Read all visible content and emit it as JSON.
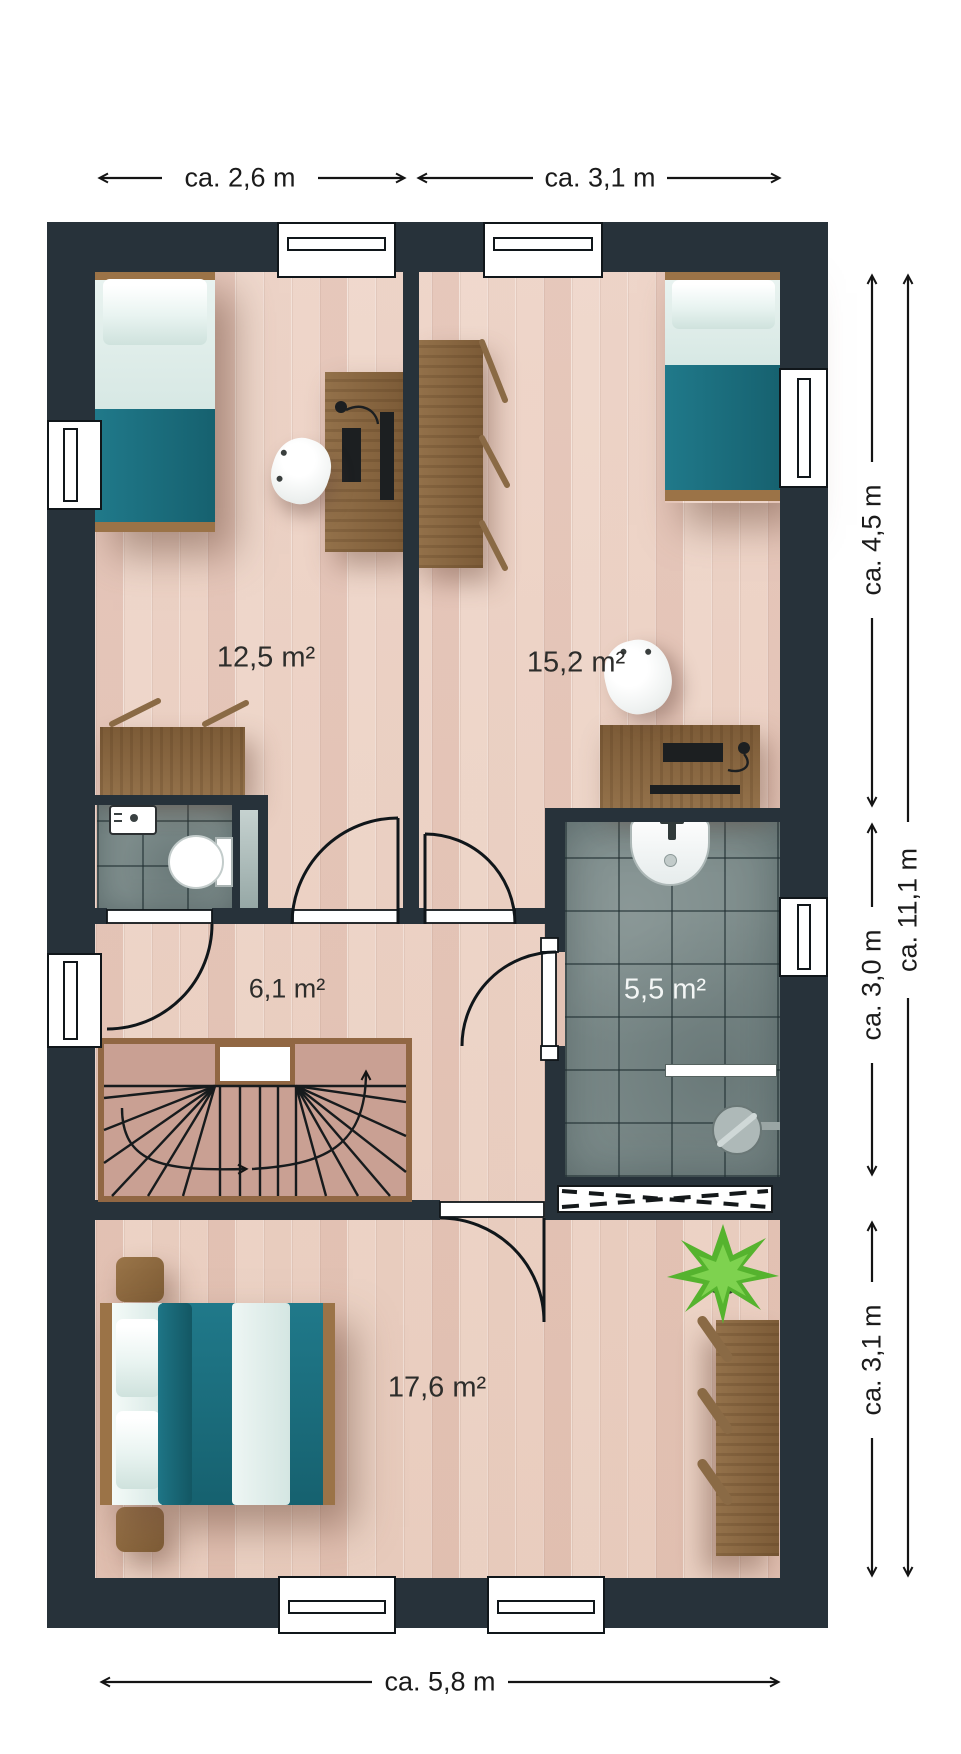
{
  "plan": {
    "type": "floor-plan",
    "rooms": {
      "bedroom_top_left": {
        "area_label": "12,5 m²"
      },
      "bedroom_top_right": {
        "area_label": "15,2 m²"
      },
      "hallway": {
        "area_label": "6,1 m²"
      },
      "bathroom": {
        "area_label": "5,5 m²"
      },
      "bedroom_bottom": {
        "area_label": "17,6 m²"
      }
    },
    "dimensions": {
      "top_left_width": "ca. 2,6 m",
      "top_right_width": "ca. 3,1 m",
      "right_upper": "ca. 4,5 m",
      "right_middle": "ca. 3,0 m",
      "right_lower": "ca. 3,1 m",
      "right_total": "ca. 11,1 m",
      "bottom_width": "ca. 5,8 m"
    },
    "colors": {
      "wall": "#27323a",
      "wood_floor": "#ecd3c6",
      "tile": "#7d8c8b",
      "stairs": "#c9a093",
      "stair_wall": "#916743",
      "bed_teal": "#1d6f7d",
      "furniture_wood": "#8d6a43",
      "plant_green": "#4caf2e"
    }
  }
}
